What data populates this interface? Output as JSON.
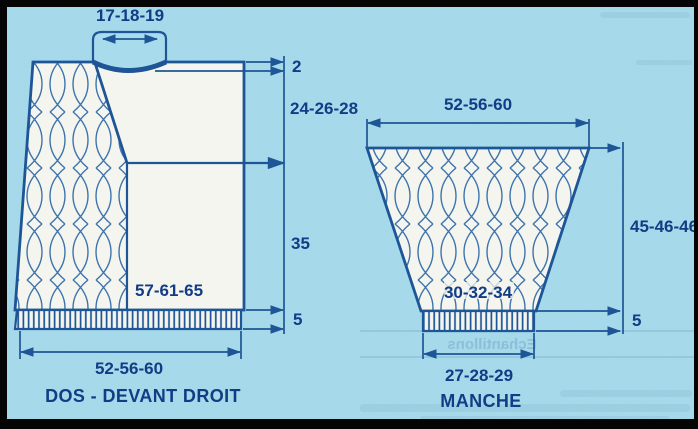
{
  "colors": {
    "background": "#a8dbec",
    "line": "#1d5596",
    "cable": "#3f73ac",
    "fill": "#f4f5ee",
    "text": "#123c85",
    "frame": "#050505"
  },
  "left_piece": {
    "caption": "DOS - DEVANT DROIT",
    "measurements": {
      "neck_width": "17-18-19",
      "neck_drop": "2",
      "yoke_depth": "24-26-28",
      "body_length": "35",
      "rib_height": "5",
      "width_above_rib": "57-61-65",
      "bottom_width": "52-56-60"
    }
  },
  "sleeve": {
    "caption": "MANCHE",
    "measurements": {
      "top_width": "52-56-60",
      "length": "45-46-46",
      "rib_height": "5",
      "width_above_rib": "30-32-34",
      "cuff_width": "27-28-29"
    }
  },
  "bleedthrough": {
    "reversed_heading": "Echantillons"
  }
}
